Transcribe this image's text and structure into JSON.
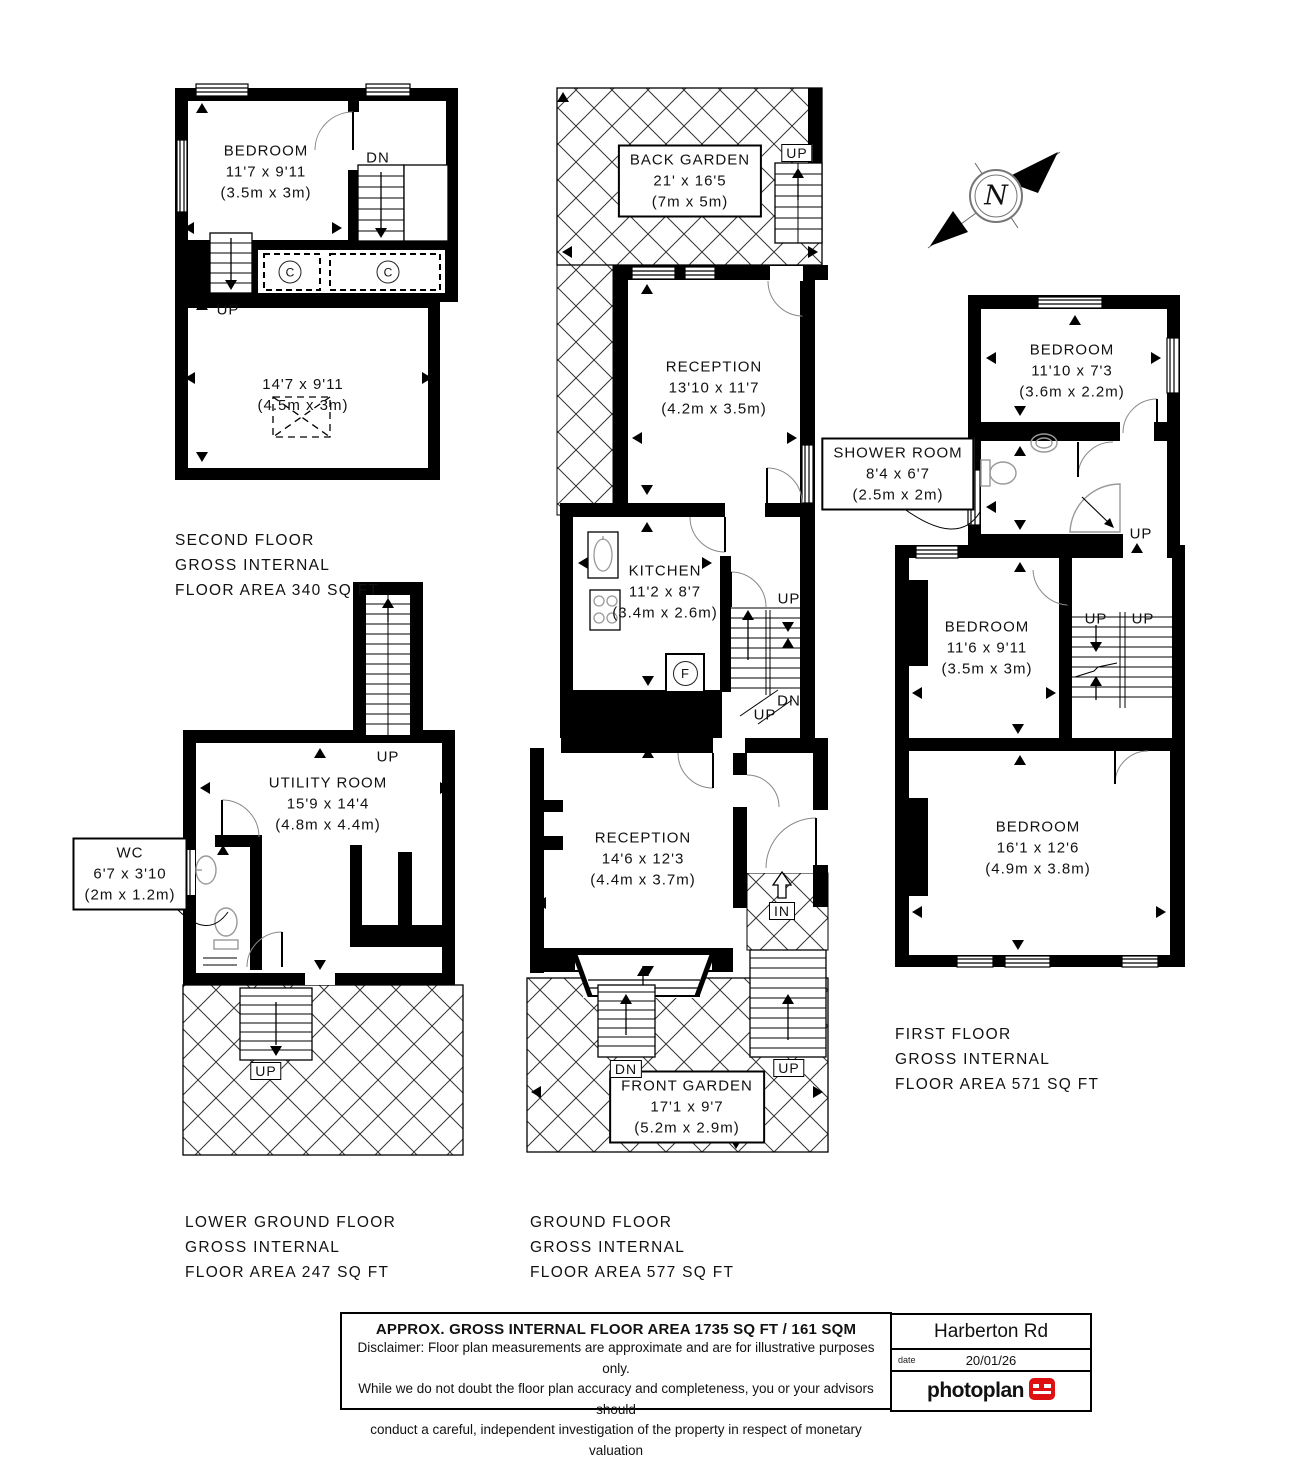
{
  "markers": {
    "up": "UP",
    "dn": "DN",
    "in": "IN",
    "closet": "C",
    "fridge": "F",
    "north": "N"
  },
  "floors": {
    "second": {
      "title": "SECOND FLOOR",
      "subtitle": "GROSS INTERNAL",
      "area": "FLOOR AREA 340 SQ FT"
    },
    "lower_ground": {
      "title": "LOWER GROUND FLOOR",
      "subtitle": "GROSS INTERNAL",
      "area": "FLOOR AREA 247 SQ FT"
    },
    "ground": {
      "title": "GROUND FLOOR",
      "subtitle": "GROSS INTERNAL",
      "area": "FLOOR AREA 577 SQ FT"
    },
    "first": {
      "title": "FIRST FLOOR",
      "subtitle": "GROSS INTERNAL",
      "area": "FLOOR AREA 571 SQ FT"
    }
  },
  "rooms": {
    "second_bedroom": {
      "name": "BEDROOM",
      "imperial": "11'7 x 9'11",
      "metric": "(3.5m x 3m)"
    },
    "second_room": {
      "name": "",
      "imperial": "14'7 x 9'11",
      "metric": "(4.5m x 3m)"
    },
    "back_garden": {
      "name": "BACK GARDEN",
      "imperial": "21' x 16'5",
      "metric": "(7m x 5m)"
    },
    "reception_rear": {
      "name": "RECEPTION",
      "imperial": "13'10 x 11'7",
      "metric": "(4.2m x 3.5m)"
    },
    "kitchen": {
      "name": "KITCHEN",
      "imperial": "11'2 x 8'7",
      "metric": "(3.4m x 2.6m)"
    },
    "reception_front": {
      "name": "RECEPTION",
      "imperial": "14'6 x 12'3",
      "metric": "(4.4m x 3.7m)"
    },
    "front_garden": {
      "name": "FRONT GARDEN",
      "imperial": "17'1 x 9'7",
      "metric": "(5.2m x 2.9m)"
    },
    "first_bedroom_rear": {
      "name": "BEDROOM",
      "imperial": "11'10 x 7'3",
      "metric": "(3.6m x 2.2m)"
    },
    "shower_room": {
      "name": "SHOWER ROOM",
      "imperial": "8'4 x 6'7",
      "metric": "(2.5m x 2m)"
    },
    "first_bedroom_mid": {
      "name": "BEDROOM",
      "imperial": "11'6 x 9'11",
      "metric": "(3.5m x 3m)"
    },
    "first_bedroom_front": {
      "name": "BEDROOM",
      "imperial": "16'1 x 12'6",
      "metric": "(4.9m x 3.8m)"
    },
    "utility_room": {
      "name": "UTILITY ROOM",
      "imperial": "15'9 x 14'4",
      "metric": "(4.8m x 4.4m)"
    },
    "wc": {
      "name": "WC",
      "imperial": "6'7 x 3'10",
      "metric": "(2m x 1.2m)"
    }
  },
  "footer": {
    "area_summary": "APPROX. GROSS INTERNAL FLOOR AREA 1735 SQ FT / 161 SQM",
    "disclaimer_line1": "Disclaimer: Floor plan measurements are approximate and are for illustrative purposes only.",
    "disclaimer_line2": "While we do not doubt the floor plan accuracy and completeness, you or your advisors should",
    "disclaimer_line3": "conduct a careful, independent investigation of the property in respect of monetary valuation",
    "address": "Harberton Rd",
    "date_label": "date",
    "date_value": "20/01/26",
    "brand": "photoplan"
  },
  "colors": {
    "wall": "#000000",
    "brand_red": "#dd1111",
    "hatch": "#333333"
  }
}
